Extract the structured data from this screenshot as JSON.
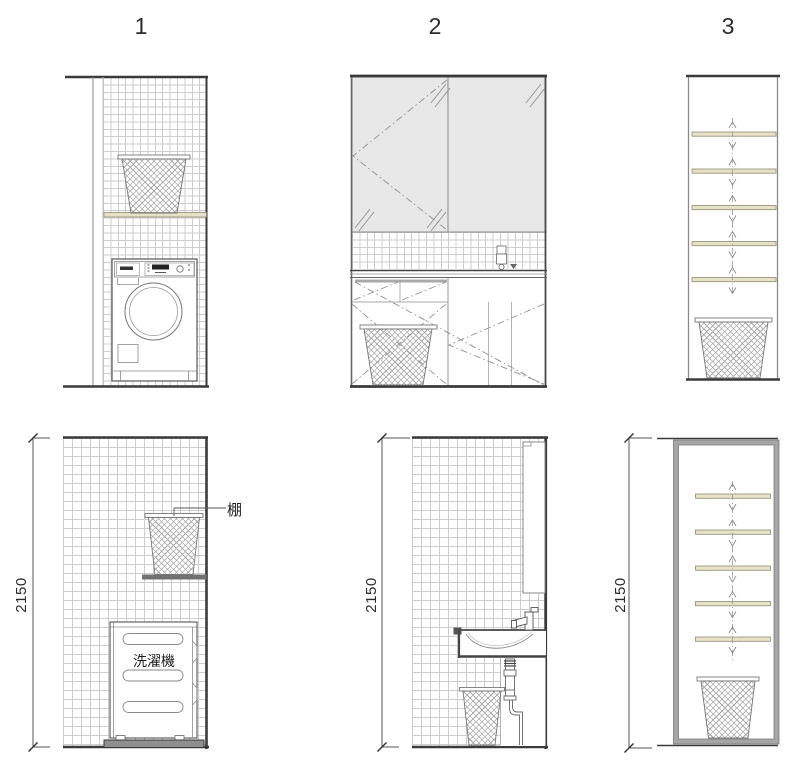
{
  "drawing": {
    "type": "interior-elevation-drawing",
    "views": {
      "columns": [
        {
          "label": "1"
        },
        {
          "label": "2"
        },
        {
          "label": "3"
        }
      ],
      "bottom_dimensions": [
        "2150",
        "2150",
        "2150"
      ]
    },
    "annotations": {
      "shelf_label": "棚",
      "washing_machine_label": "洗濯機"
    },
    "colors": {
      "line_dark": "#3a3a3a",
      "line_mid": "#777777",
      "tile_grid": "#cdcdcd",
      "mirror_fill": "#e8e8e8",
      "shelf_fill": "#e6e2c6",
      "shelf_edge": "#8f8b74",
      "frame_gray": "#a6a6a6",
      "dark_shelf": "#707070"
    }
  }
}
